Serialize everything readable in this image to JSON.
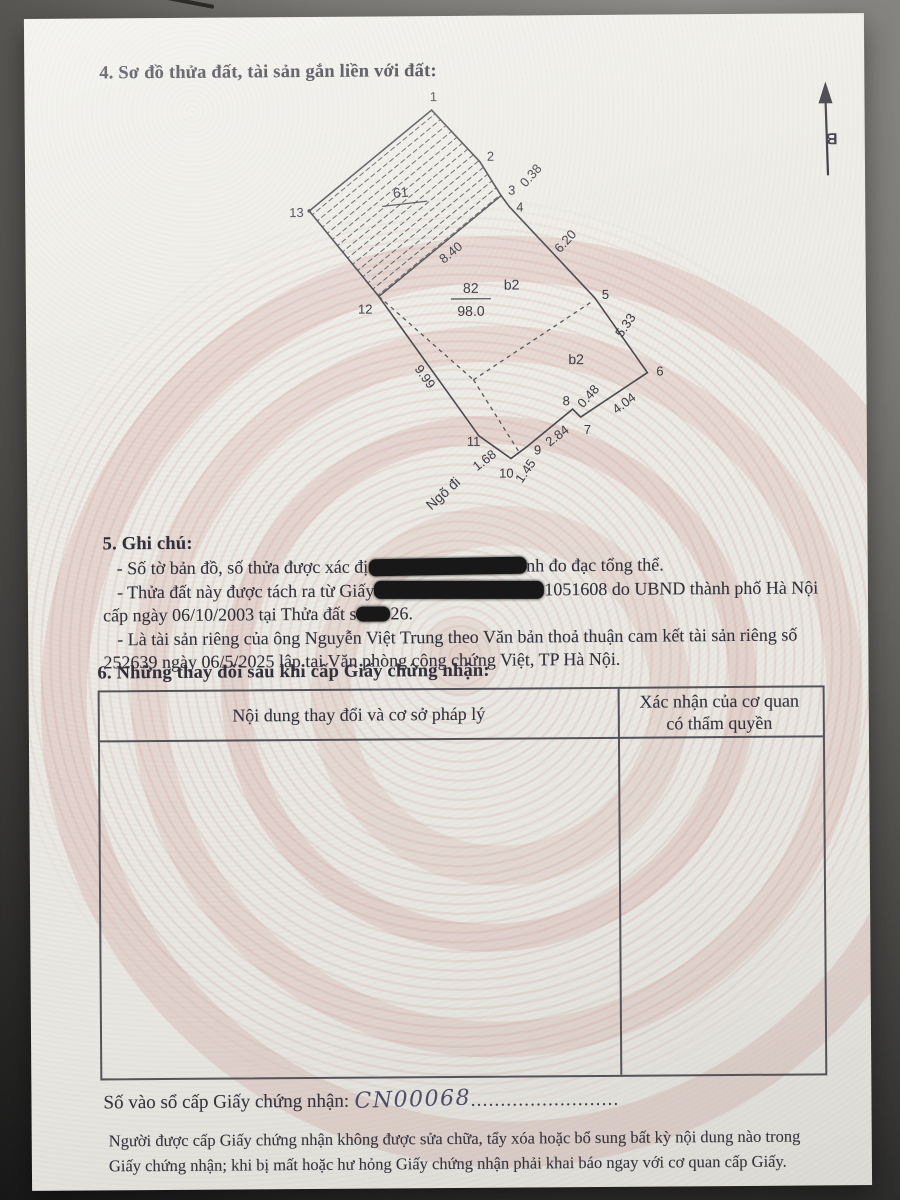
{
  "document": {
    "section4": {
      "title": "4. Sơ đồ thửa đất, tài sản gắn liền với đất:"
    },
    "north": {
      "label": "B"
    },
    "diagram": {
      "vertices": [
        "1",
        "2",
        "3",
        "4",
        "5",
        "6",
        "7",
        "8",
        "9",
        "10",
        "11",
        "12",
        "13"
      ],
      "dims": {
        "e3_4": "0.38",
        "e4_5": "6.20",
        "e5_6": "5.33",
        "e6_7": "4.04",
        "e7_8": "0.48",
        "e8_9": "2.84",
        "e9_10": "1.45",
        "e10_11": "1.68",
        "e11_12": "9.99",
        "inner": "8.40"
      },
      "labels": {
        "hatched_plot": "61",
        "plot_number": "82",
        "plot_area": "98.0",
        "b2_upper": "b2",
        "b2_lower": "b2",
        "alley": "Ngõ đi"
      }
    },
    "section5": {
      "title": "5. Ghi chú:",
      "line1_pre": "- Số tờ bản đồ, số thửa được xác đị",
      "line1_post": "nh đo đạc tổng thể.",
      "line2_pre": "- Thửa đất này được tách ra từ Giấy",
      "line2_post": "1051608 do UBND thành phố Hà Nội",
      "line3_pre": "cấp ngày 06/10/2003 tại Thửa đất s",
      "line3_post": "26.",
      "line4": "- Là tài sản riêng của ông Nguyễn Việt Trung theo Văn bản thoả thuận cam kết tài sản riêng số",
      "line5": "252639 ngày 06/5/2025 lập tại Văn phòng công chứng Việt, TP Hà Nội."
    },
    "section6": {
      "title": "6. Những thay đổi sau khi cấp Giấy chứng nhận:",
      "table": {
        "col1_header": "Nội dung thay đổi và cơ sở pháp lý",
        "col2_header_line1": "Xác nhận của cơ quan",
        "col2_header_line2": "có thẩm quyền"
      }
    },
    "register": {
      "label": "Số vào sổ cấp Giấy chứng nhận:",
      "number": "CN00068",
      "dots": "........................."
    },
    "footer": {
      "line1": "Người được cấp Giấy chứng nhận không được sửa chữa, tẩy xóa hoặc bổ sung bất kỳ nội dung nào trong",
      "line2": "Giấy chứng nhận; khi bị mất hoặc hư hỏng Giấy chứng nhận phải khai báo ngay với cơ quan cấp Giấy."
    },
    "colors": {
      "pattern_pink": "#d9b8b4",
      "paper": "#edece6",
      "ink": "#2f2f3a",
      "redaction": "#161616"
    }
  }
}
